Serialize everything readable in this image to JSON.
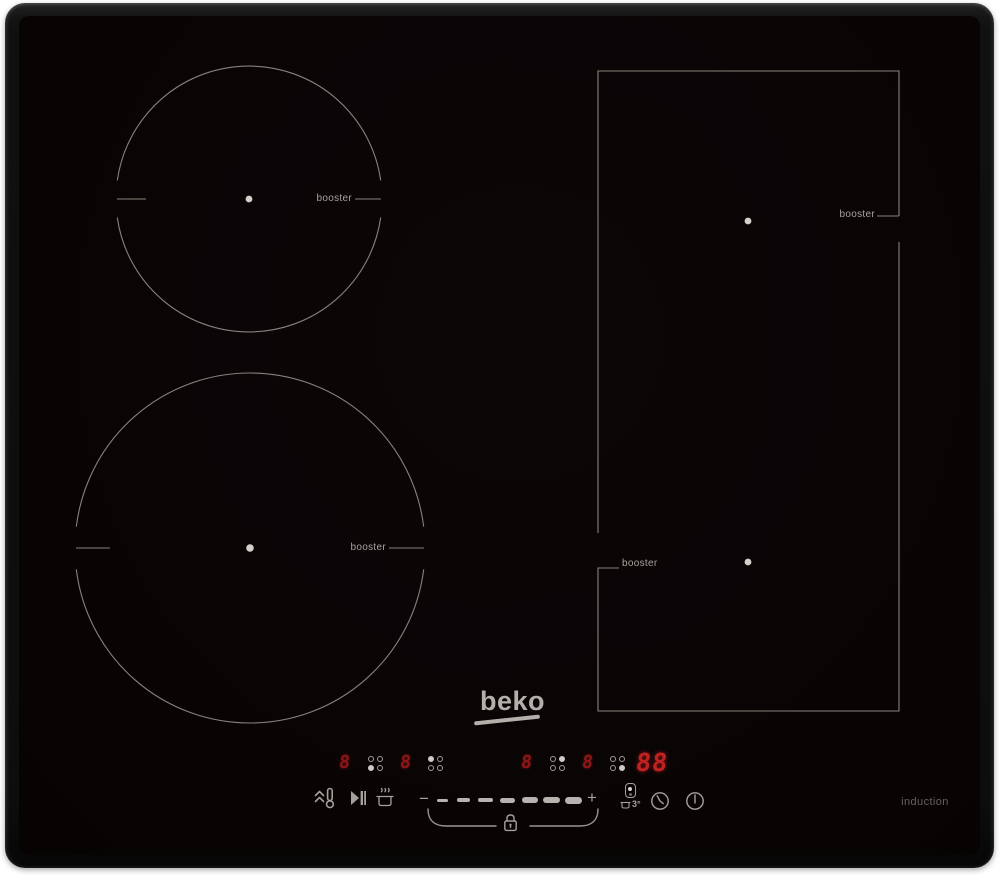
{
  "brand": {
    "logo_text": "beko",
    "induction_label": "induction"
  },
  "zones": {
    "top_left": {
      "booster_label": "booster"
    },
    "bottom_left": {
      "booster_label": "booster"
    },
    "flex_top_right": {
      "booster_label": "booster"
    },
    "flex_bottom_right": {
      "booster_label": "booster"
    }
  },
  "displays": {
    "zone_displays": [
      {
        "value": "8",
        "indicator": "bottom-left"
      },
      {
        "value": "8",
        "indicator": "top-left"
      },
      {
        "value": "8",
        "indicator": "top-right"
      },
      {
        "value": "8",
        "indicator": "bottom-right"
      }
    ],
    "timer_display": {
      "value": "88"
    }
  },
  "controls": {
    "heat_up_icon": "heat-up-thermometer",
    "pause_icon": "play-pause",
    "keep_warm_icon": "keep-warm-pot",
    "minus_label": "−",
    "plus_label": "+",
    "slider_segments": 7,
    "lock_icon": "padlock",
    "zone_select_icon": "flex-zone-select",
    "preset_label": "3°",
    "timer_icon": "clock",
    "power_icon": "power"
  },
  "colors": {
    "glass": "#0a0505",
    "zone_line": "#8f8982",
    "led_dim_red": "#8d1616",
    "led_bright_red": "#c32121",
    "icon_gray": "#a5a09a"
  }
}
